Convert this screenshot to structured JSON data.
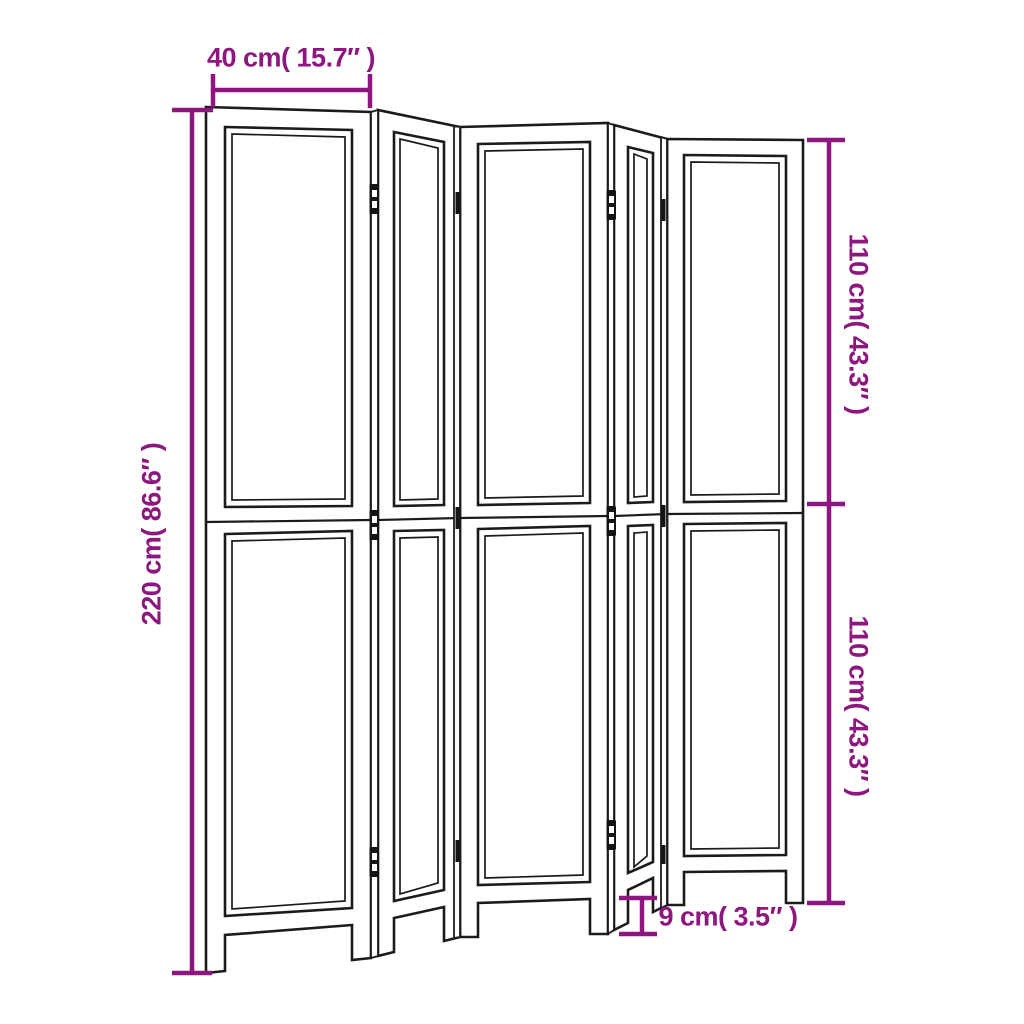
{
  "diagram": {
    "panel_count": 5,
    "dimension_labels": {
      "width": "40 cm( 15.7″ )",
      "total_height": "220 cm( 86.6″ )",
      "upper_section_height": "110 cm( 43.3″ )",
      "lower_section_height": "110 cm( 43.3″ )",
      "foot_height": "9 cm( 3.5″ )"
    }
  },
  "colors": {
    "accent": "#8D177E",
    "line": "#1b1b1b",
    "background": "#ffffff"
  }
}
